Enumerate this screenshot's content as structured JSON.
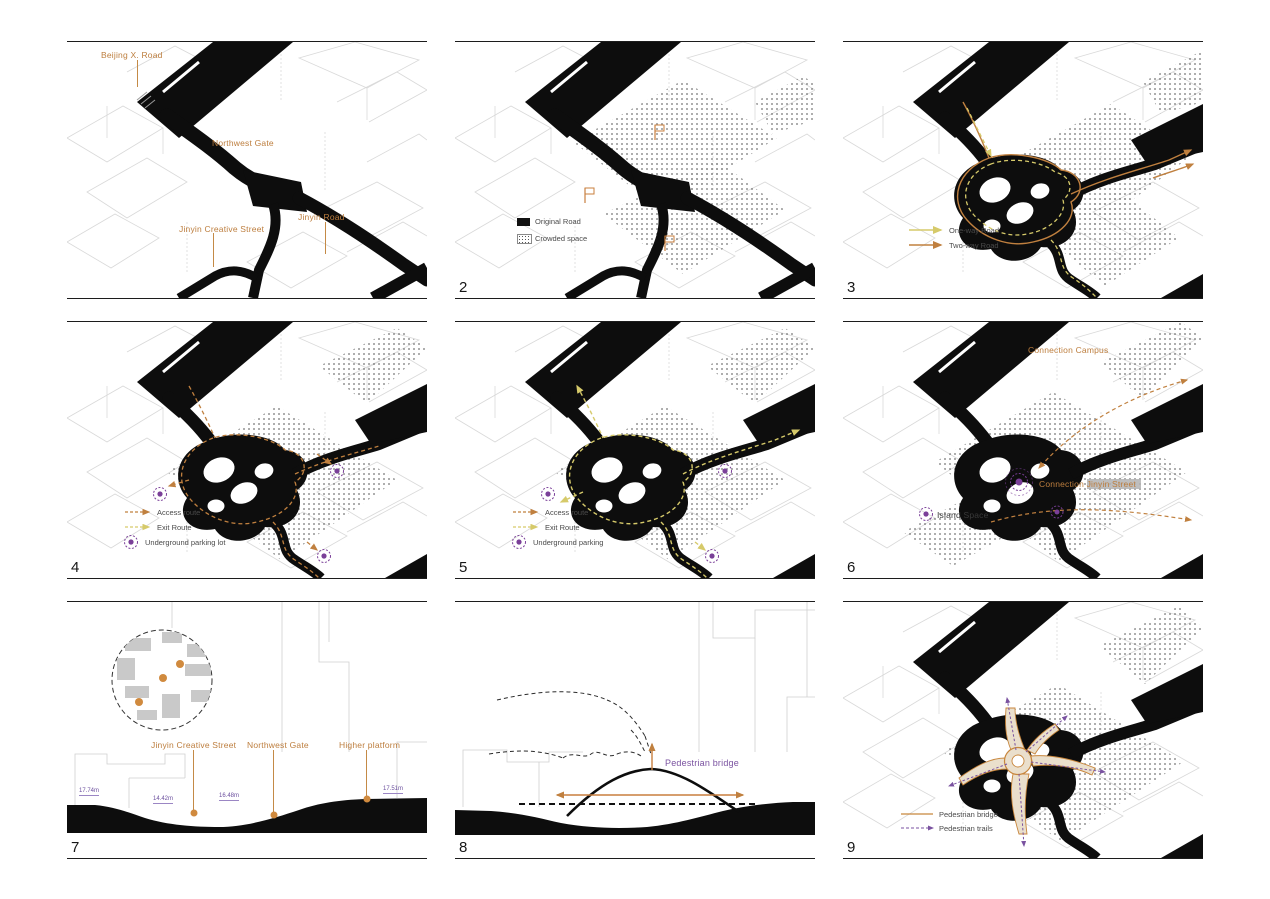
{
  "colors": {
    "road_black": "#0d0d0d",
    "accent_orange": "#c0803f",
    "accent_yellow": "#d6ca6a",
    "accent_purple": "#7a52a0",
    "bridge_beige": "#eadfcc"
  },
  "panels": {
    "p1": {
      "labels": {
        "beijing_road": "Beijing X. Road",
        "northwest_gate": "Northwest Gate",
        "jinyin_road": "Jinyin Road",
        "jinyin_creative_street": "Jinyin Creative Street"
      }
    },
    "p2": {
      "number": "2",
      "legend": {
        "original_road": "Original Road",
        "crowded_space": "Crowded space"
      }
    },
    "p3": {
      "number": "3",
      "legend": {
        "one_way": "One-way Road",
        "two_way": "Two-way Road"
      }
    },
    "p4": {
      "number": "4",
      "legend": {
        "access": "Access route",
        "exit": "Exit Route",
        "parking": "Underground parking lot"
      }
    },
    "p5": {
      "number": "5",
      "legend": {
        "access": "Access route",
        "exit": "Exit Route",
        "parking": "Underground parking"
      }
    },
    "p6": {
      "number": "6",
      "labels": {
        "connection_campus": "Connection Campus",
        "island_space": "Island Space",
        "connection_jinyin": "Connection Jinyin Street"
      }
    },
    "p7": {
      "number": "7",
      "labels": {
        "jinyin_creative_street": "Jinyin Creative Street",
        "northwest_gate": "Northwest Gate",
        "higher_platform": "Higher platform"
      },
      "elevations": {
        "e1": "17.74m",
        "e2": "14.42m",
        "e3": "16.48m",
        "e4": "17.51m"
      }
    },
    "p8": {
      "number": "8",
      "labels": {
        "pedestrian_bridge": "Pedestrian bridge"
      }
    },
    "p9": {
      "number": "9",
      "legend": {
        "bridge": "Pedestrian bridge",
        "trails": "Pedestrian trails"
      }
    }
  }
}
